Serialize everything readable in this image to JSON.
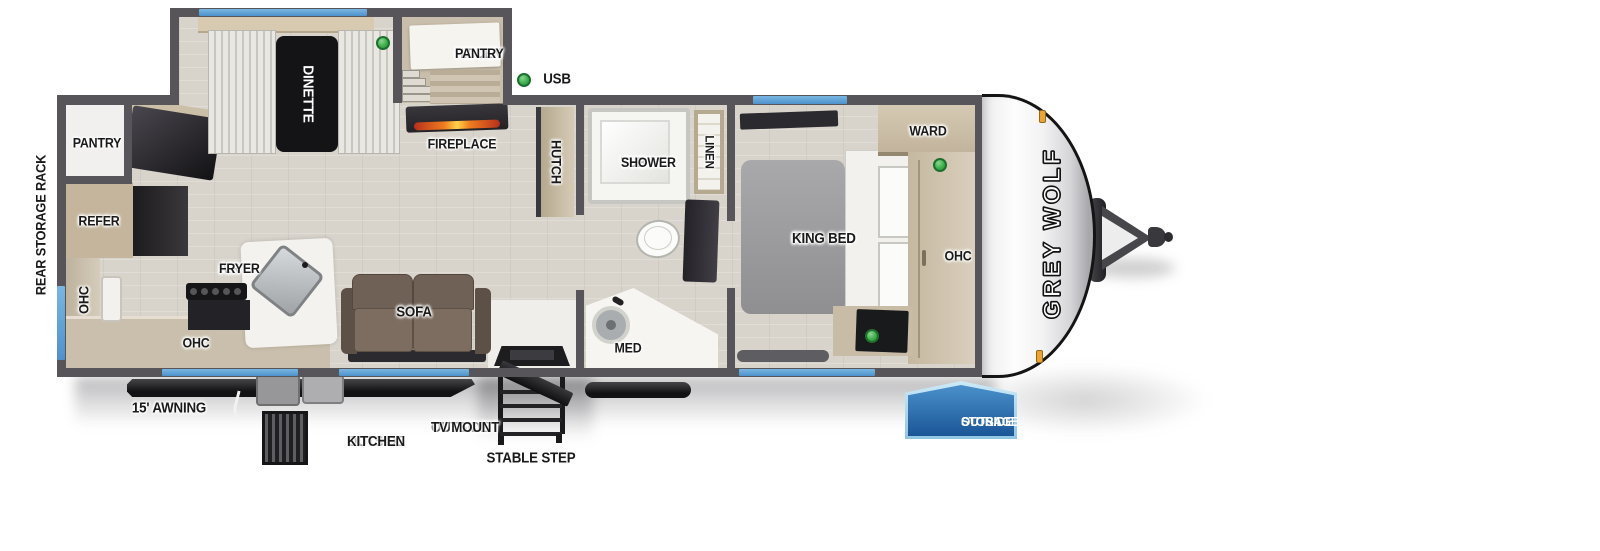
{
  "title_text": "travel trailer floorplan",
  "brand": {
    "name_vertical": "GREY WOLF"
  },
  "legend": {
    "usb_label": "USB"
  },
  "interior": {
    "rear": {
      "pantry": "PANTRY",
      "refer": "REFER",
      "ohc": "OHC"
    },
    "kitchen": {
      "air_fryer": [
        "AIR",
        "FRYER"
      ],
      "ohc": "OHC"
    },
    "dinette": {
      "label": "DINETTE",
      "hidden_pantry": [
        "HIDDEN",
        "PANTRY"
      ]
    },
    "living": {
      "fireplace": "FIREPLACE",
      "hutch": "HUTCH",
      "sofa": "SOFA"
    },
    "bath": {
      "tub_shower": [
        "TUB /",
        "SHOWER"
      ],
      "linen": "LINEN",
      "med": "MED"
    },
    "bedroom": {
      "bed": [
        "RV",
        "KING BED"
      ],
      "ward": "WARD",
      "ohc": "OHC"
    }
  },
  "exterior": {
    "rear_storage_rack": "REAR STORAGE RACK",
    "awning": "15' AWNING",
    "outside_kitchen": [
      "OUTSIDE",
      "KITCHEN"
    ],
    "outside_tv_mount": [
      "OUTSIDE",
      "TV MOUNT"
    ],
    "stable_step": "STABLE STEP",
    "outside_storage": [
      "OUTSIDE",
      "STORAGE"
    ]
  },
  "colors": {
    "wall_gray": "#57555a",
    "floor_wood": "#d8d3cb",
    "window_blue": "#5b9fd4",
    "marker_green": "#3db04a",
    "badge_blue_top": "#4a90cb",
    "badge_blue_bottom": "#1b5697",
    "sofa_brown": "#6e6156",
    "flame_orange": "#f07c1f"
  },
  "icons": {
    "marker": "green-usb-marker-icon",
    "grill": "outside-kitchen-grill-icon",
    "step": "stable-step-icon",
    "hitch": "trailer-hitch-icon"
  }
}
